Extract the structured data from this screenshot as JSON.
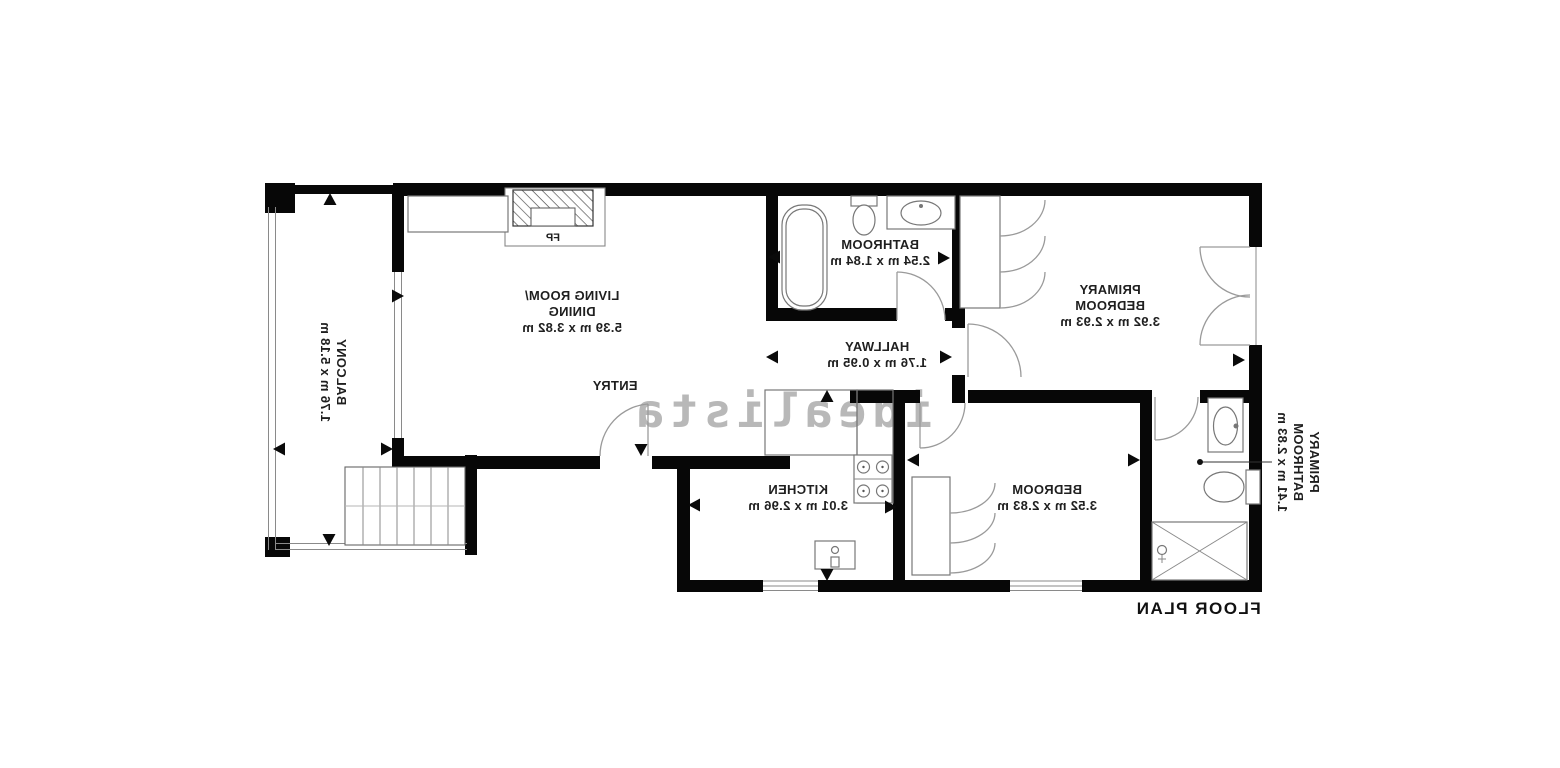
{
  "watermark": "idealista",
  "plan_title": "FLOOR PLAN",
  "colors": {
    "wall": "#070707",
    "label": "#1f1f1f",
    "fixture_line": "#777777",
    "watermark": "#b5b5b5"
  },
  "rooms": {
    "living": {
      "lines": [
        "LIVING ROOM/",
        "DINING",
        "5.39 m x 3.82 m"
      ]
    },
    "bathroom": {
      "lines": [
        "BATHROOM",
        "2.54 m x 1.84 m"
      ]
    },
    "primary_bedroom": {
      "lines": [
        "PRIMARY",
        "BEDROOM",
        "3.92 m x 2.93 m"
      ]
    },
    "hallway": {
      "lines": [
        "HALLWAY",
        "1.76 m x 0.95 m"
      ]
    },
    "kitchen": {
      "lines": [
        "KITCHEN",
        "3.01 m x 2.96 m"
      ]
    },
    "bedroom": {
      "lines": [
        "BEDROOM",
        "3.52 m x 2.83 m"
      ]
    },
    "primary_bathroom": {
      "lines": [
        "PRIMARY",
        "BATHROOM",
        "1.41 m x 2.83 m"
      ]
    },
    "balcony": {
      "lines": [
        "BALCONY",
        "1.76 m x 5.18 m"
      ]
    },
    "entry": {
      "label": "ENTRY"
    },
    "fireplace": {
      "label": "FP"
    }
  }
}
